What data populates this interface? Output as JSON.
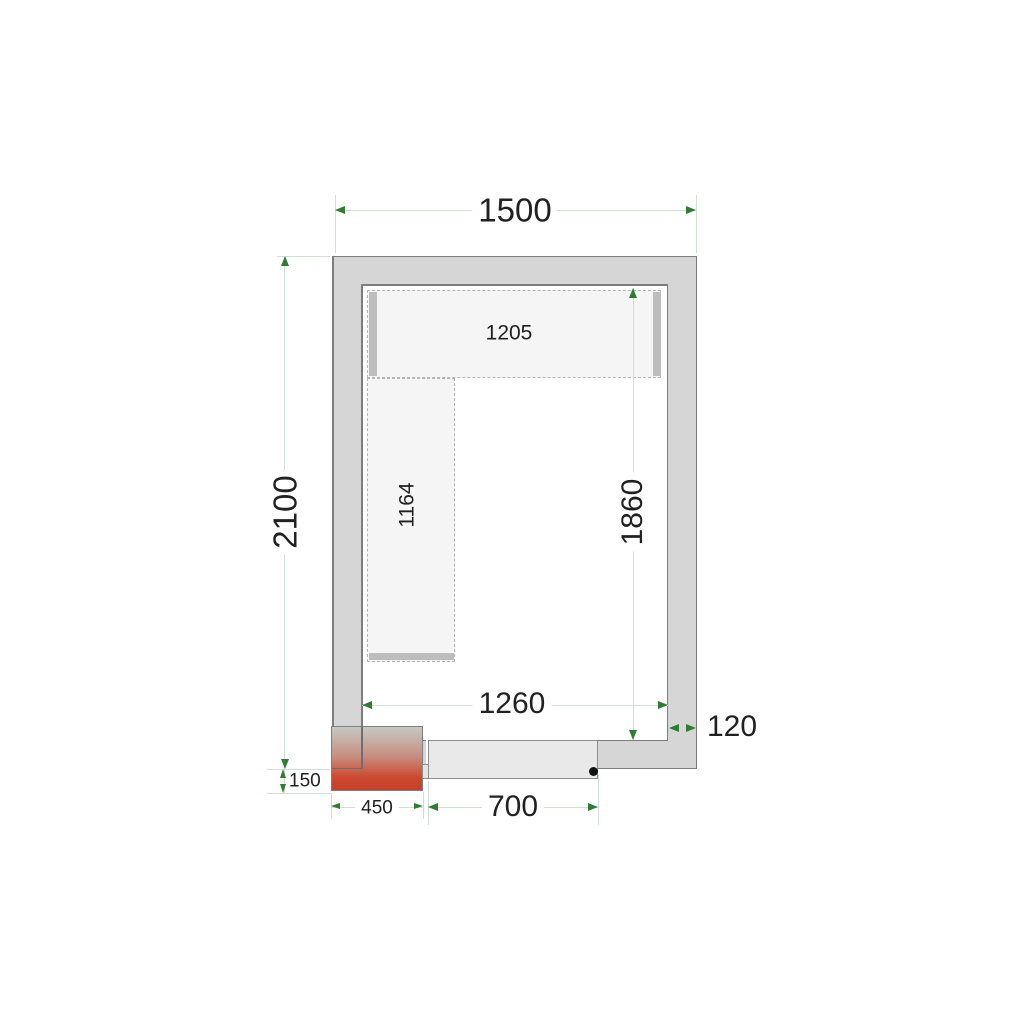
{
  "labels": {
    "outer_width": "1500",
    "outer_height": "2100",
    "inner_width": "1260",
    "inner_height": "1860",
    "wall_thickness": "120",
    "top_shelf_length": "1205",
    "left_shelf_length": "1164",
    "unit_offset_depth": "150",
    "unit_width": "450",
    "door_width": "700"
  },
  "icons": {
    "dim_arrow": "triangle",
    "door_handle": "dot"
  },
  "colors": {
    "wall_fill": "#d6d6d6",
    "wall_line": "#7d7d7d",
    "shelf_fill": "#f5f5f5",
    "shelf_line": "#b5b5b5",
    "bar": "#bdbdbd",
    "dim_line": "#cfe2cf",
    "dim_arrow": "#2e7d32",
    "txt": "#212121",
    "grad_top": "#c4c8c3",
    "grad_bottom": "#cc4830",
    "door_fill": "#e9e9e9",
    "door_line": "#8d8d8d",
    "dot": "#111111"
  }
}
